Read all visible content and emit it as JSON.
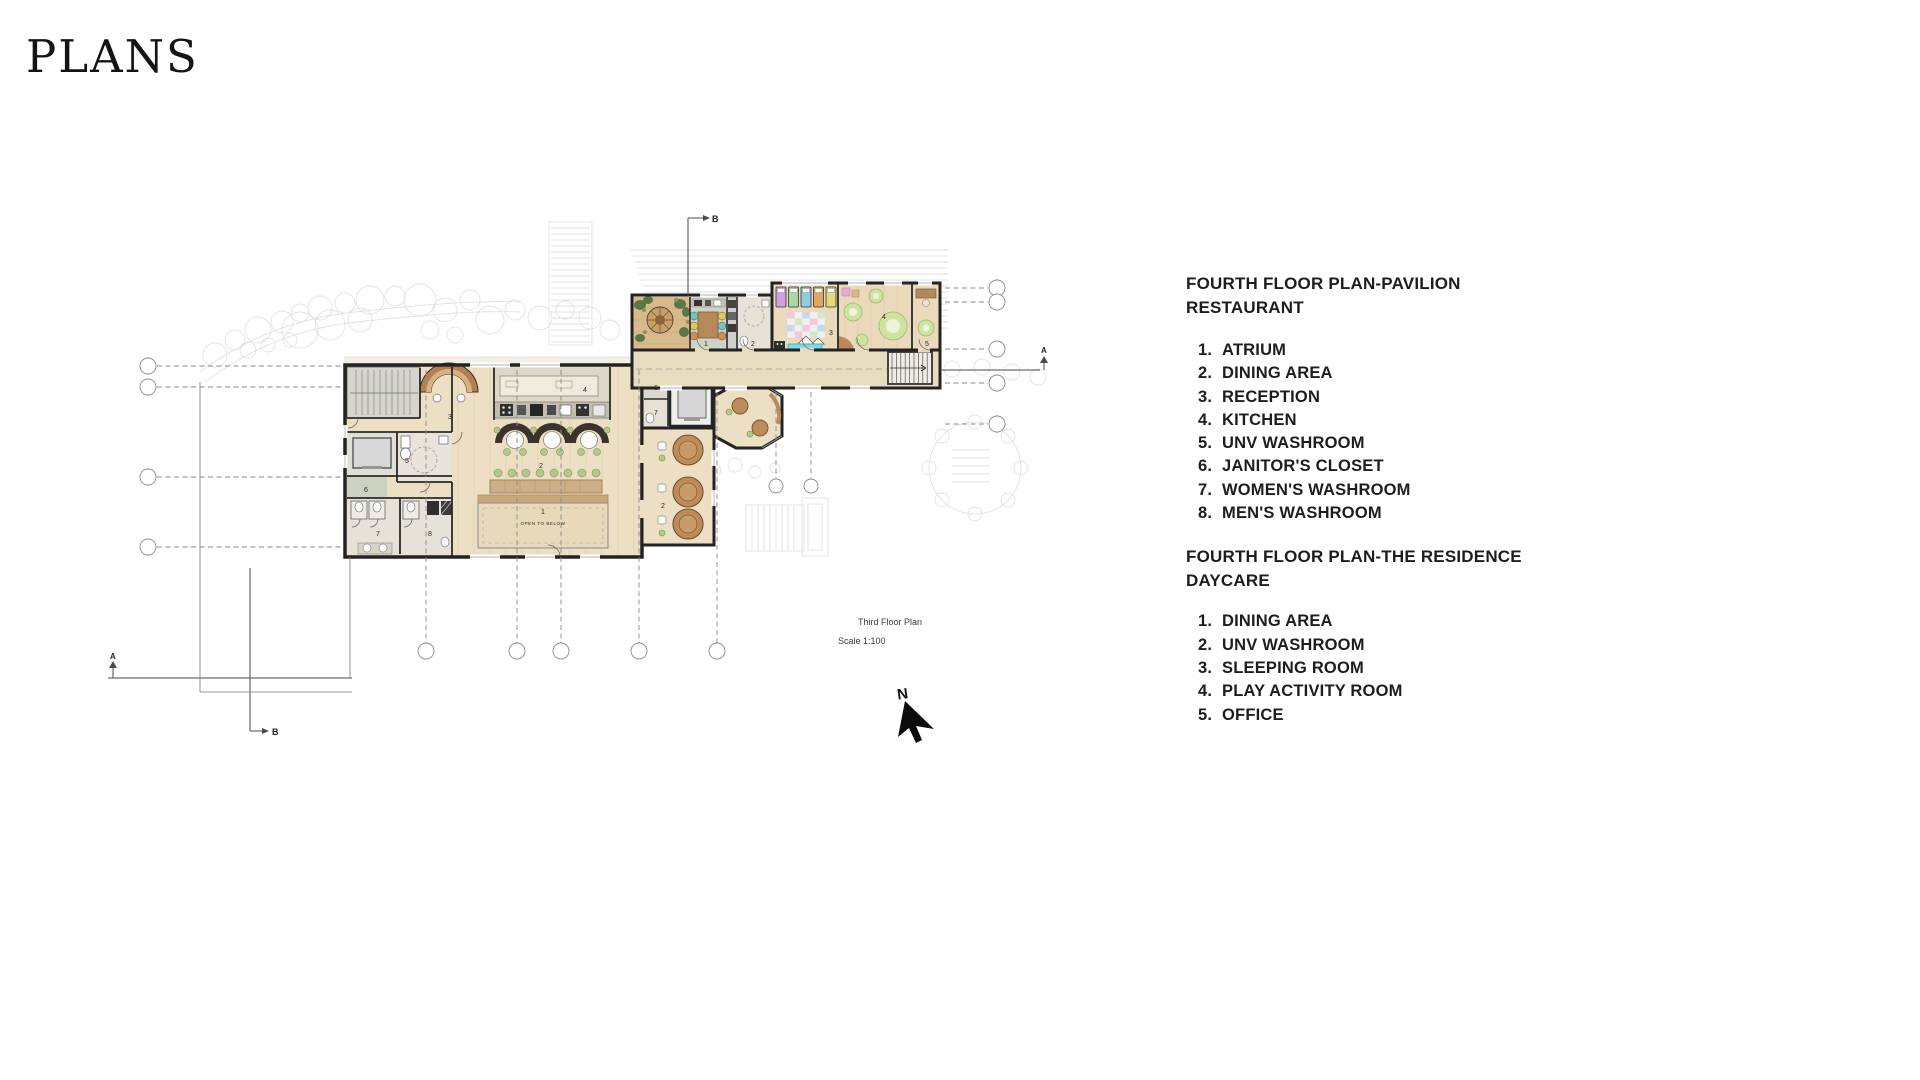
{
  "title": "PLANS",
  "legend": {
    "sections": [
      {
        "heading_line1": "FOURTH FLOOR PLAN-PAVILION",
        "heading_line2": "RESTAURANT",
        "items": [
          {
            "n": "1.",
            "t": "ATRIUM"
          },
          {
            "n": "2.",
            "t": "DINING AREA"
          },
          {
            "n": "3.",
            "t": "RECEPTION"
          },
          {
            "n": "4.",
            "t": "KITCHEN"
          },
          {
            "n": "5.",
            "t": "UNV WASHROOM"
          },
          {
            "n": "6.",
            "t": "JANITOR'S CLOSET"
          },
          {
            "n": "7.",
            "t": "WOMEN'S WASHROOM"
          },
          {
            "n": "8.",
            "t": "MEN'S WASHROOM"
          }
        ]
      },
      {
        "heading_line1": "FOURTH FLOOR PLAN-THE RESIDENCE",
        "heading_line2": "DAYCARE",
        "items": [
          {
            "n": "1.",
            "t": "DINING AREA"
          },
          {
            "n": "2.",
            "t": "UNV WASHROOM"
          },
          {
            "n": "3.",
            "t": "SLEEPING ROOM"
          },
          {
            "n": "4.",
            "t": "PLAY ACTIVITY ROOM"
          },
          {
            "n": "5.",
            "t": "OFFICE"
          }
        ]
      }
    ]
  },
  "plan": {
    "caption": {
      "title": "Third Floor Plan",
      "scale": "Scale 1:100"
    },
    "north_label": "N",
    "open_to_below": "OPEN TO BELOW",
    "section_labels": {
      "a_left": "A",
      "a_right": "A",
      "b_top": "B",
      "b_bottom": "B"
    },
    "room_labels": {
      "restaurant": {
        "atrium": "1",
        "dining_main": "2",
        "dining_round": "2",
        "reception": "3",
        "kitchen": "4",
        "unv_washroom": "5",
        "janitor": "6",
        "women": "7",
        "men": "8",
        "conn_janitor": "6",
        "conn_women": "7"
      },
      "daycare": {
        "dining": "1",
        "unv_washroom": "2",
        "sleeping": "3",
        "play": "4",
        "office": "5"
      }
    },
    "colors": {
      "floor_wood": "#ecdfc4",
      "floor_warm": "#d9ba8c",
      "wall": "#232323",
      "accent_green": "#b2c98b",
      "rug_green": "#cfe3a0",
      "bench_cyan": "#79dbe8",
      "wood_furniture": "#bd8c5a"
    }
  }
}
